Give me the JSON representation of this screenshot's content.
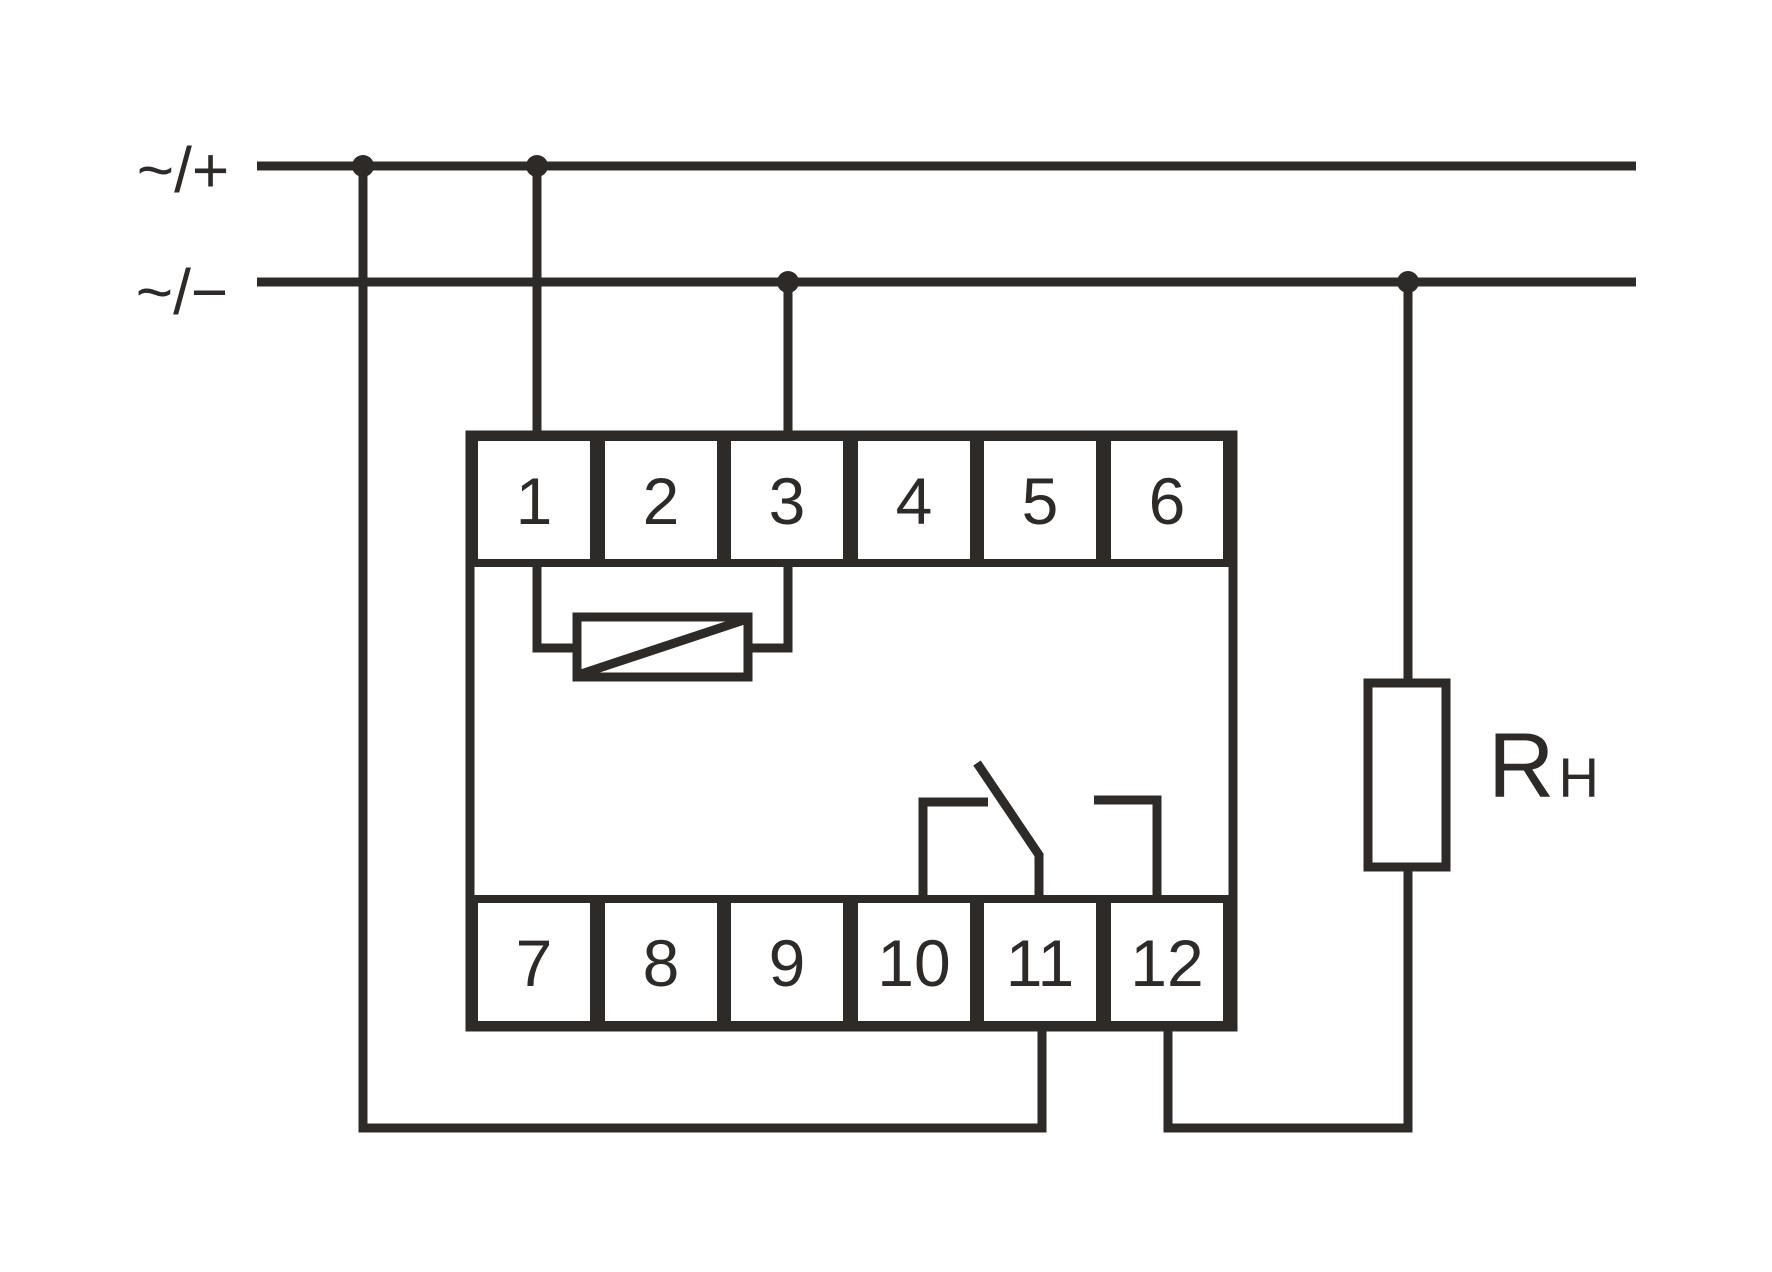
{
  "diagram": {
    "title": "relay-module-wiring-diagram",
    "rails": {
      "top_label": "~/+",
      "bottom_label": "~/−"
    },
    "terminals": {
      "top": [
        "1",
        "2",
        "3",
        "4",
        "5",
        "6"
      ],
      "bottom": [
        "7",
        "8",
        "9",
        "10",
        "11",
        "12"
      ]
    },
    "load": {
      "label_main": "R",
      "label_sub": "H"
    },
    "symbols": {
      "coil": "control-coil between terminals 1 and 3",
      "contact": "changeover contact over terminals 10, 11, 12",
      "resistor": "load resistor RH"
    },
    "connections": [
      "top rail ~/+ junction 1 -> down -> bottom loop -> terminal 11",
      "top rail ~/+ junction 2 -> down -> terminal 1",
      "bottom rail ~/− junction -> down -> terminal 3",
      "coil connected between terminal 1 and terminal 3",
      "terminal 12 -> down -> right -> load RH -> bottom rail ~/−"
    ],
    "colors": {
      "line": "#2d2a28",
      "background": "#ffffff"
    }
  }
}
